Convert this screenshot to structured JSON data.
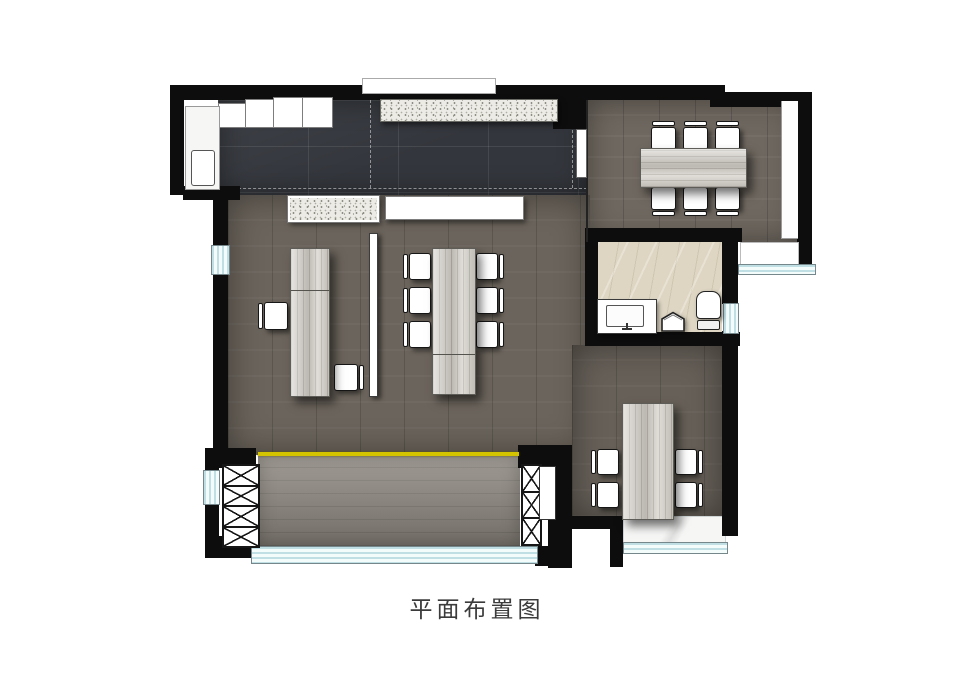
{
  "caption": "平面布置图",
  "palette": {
    "wall": "#0d0d0d",
    "tileFloor": "#33363c",
    "woodMeeting": "#6f6860",
    "woodOffice": "#6b645c",
    "woodBalcony": "#8c867e",
    "furnitureWood": "#d6d2cb",
    "marbleBath": "#ded6c3",
    "marbleWhite": "#f6f6f5",
    "windowBlue": "#bfdfe4",
    "accentYellow": "#d4c400",
    "terrazzo": "#ecebe5",
    "caption": "#3b3b3b"
  },
  "furniture_counts": {
    "meeting_room": {
      "tables": 1,
      "chairs": 6
    },
    "open_office": {
      "desks": 2,
      "chairs": 8,
      "partition_screens": 1
    },
    "private_office": {
      "desks": 1,
      "chairs": 4
    },
    "bathroom": {
      "vanity_sinks": 1,
      "mop_basins": 1,
      "toilets": 1
    },
    "balcony_columns_x_braced": 2
  }
}
